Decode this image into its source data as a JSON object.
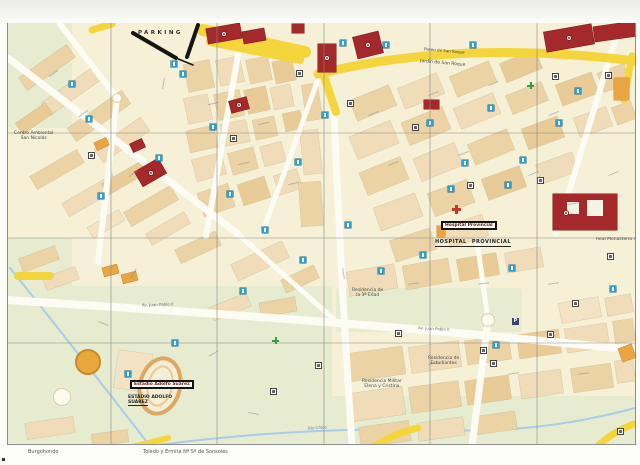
{
  "page": {
    "captions": {
      "left": "Burgohondo",
      "center": "Toledo y Ermita Nª Sª de Sonsoles"
    }
  },
  "map": {
    "labels": {
      "parking": "PARKING",
      "paseo_san_roque": "Paseo de San Roque",
      "jardin_san_roque": "Jardín de San Roque",
      "hospital_box": "Hospital Provincial",
      "hospital_caps": "HOSPITAL  PROVINCIAL",
      "estadio_box": "Estadio Adolfo Suárez",
      "estadio_caps_1": "ESTADIO ADOLFO",
      "estadio_caps_2": "SUÁREZ",
      "monasterio": "Real Monasterio de S...",
      "centro_ambiental_1": "Centro Ambiental",
      "centro_ambiental_2": "San Nicolás",
      "residencia_estudiantes_1": "Residencia de",
      "residencia_estudiantes_2": "Estudiantes",
      "residencia_militar_1": "Residencia Militar",
      "residencia_militar_2": "Elena y Cristina",
      "residencia_3edad_1": "Residencia de",
      "residencia_3edad_2": "la 3ª Edad",
      "rio_chico": "Río Chico",
      "av_juan_pablo": "Av. Juan Pablo II"
    },
    "colors": {
      "background": "#f5f0d6",
      "block": "#ecd3a6",
      "building_red": "#a5282a",
      "building_orange": "#e9a544",
      "road_main": "#f5d53c",
      "park": "#e7ecd0",
      "water": "#a9cde9",
      "icon_blue": "#2ba0d6",
      "wall_black": "#151515",
      "pharmacy_green": "#2f9e44",
      "hospital_red": "#c0392b"
    },
    "parks": [
      [
        0,
        0,
        64,
        105
      ],
      [
        0,
        215,
        64,
        110
      ],
      [
        0,
        263,
        324,
        158
      ],
      [
        322,
        373,
        305,
        48
      ],
      [
        328,
        265,
        186,
        44
      ],
      [
        52,
        337,
        120,
        86
      ]
    ],
    "river": [
      "M2,245 Q52,307 142,423",
      "M142,423 Q292,403 432,407",
      "M432,407 Q532,411 627,385"
    ],
    "roads_white": [
      [
        "M0,35 L230,211",
        7
      ],
      [
        "M109,75 L90,239",
        6
      ],
      [
        "M52,1 L109,75",
        6
      ],
      [
        "M0,277 C142,287 312,295 627,327",
        8
      ],
      [
        "M232,21 L198,213",
        6
      ],
      [
        "M326,89 Q332,237 344,423",
        7
      ],
      [
        "M480,297 L464,423",
        7
      ],
      [
        "M480,297 L469,217",
        5
      ],
      [
        "M612,1 L548,211",
        6
      ],
      [
        "M312,51 L254,211",
        5
      ],
      [
        "M230,211 L330,300",
        5
      ]
    ],
    "roads_yellow": [
      [
        "M310,51 Q450,16 627,38",
        9
      ],
      [
        "M314,47 L328,89",
        8
      ],
      [
        "M195,7 L297,29",
        12
      ],
      [
        "M202,19 L292,37",
        8
      ],
      [
        "M366,423 Q390,409 410,405",
        7
      ],
      [
        "M590,423 Q604,409 626,401",
        7
      ],
      [
        "M120,425 L160,415",
        6
      ],
      [
        "M624,33 L616,77",
        7
      ],
      [
        "M84,7 L104,1",
        7
      ],
      [
        "M10,253 L42,253",
        8
      ]
    ],
    "walls": [
      [
        "M125,10 L168,35",
        4
      ],
      [
        "M190,2 L179,34",
        4
      ],
      [
        "M168,35 L185,42",
        1.5
      ]
    ],
    "grid_x": [
      103,
      209,
      316,
      422,
      529
    ],
    "grid_y": [
      110,
      215,
      320
    ],
    "blocks": [
      [
        10,
        37,
        58,
        15,
        -35,
        0
      ],
      [
        32,
        61,
        62,
        15,
        -35,
        1
      ],
      [
        58,
        85,
        66,
        16,
        -35,
        0
      ],
      [
        8,
        89,
        36,
        13,
        -35,
        2
      ],
      [
        86,
        109,
        56,
        16,
        -35,
        1
      ],
      [
        22,
        139,
        54,
        15,
        -30,
        0
      ],
      [
        54,
        165,
        58,
        15,
        -30,
        1
      ],
      [
        94,
        149,
        44,
        13,
        -30,
        2
      ],
      [
        116,
        175,
        54,
        16,
        -30,
        0
      ],
      [
        138,
        199,
        44,
        13,
        -30,
        1
      ],
      [
        80,
        195,
        36,
        12,
        -30,
        3
      ],
      [
        178,
        39,
        26,
        28,
        -12,
        0
      ],
      [
        210,
        35,
        24,
        26,
        -12,
        1
      ],
      [
        240,
        35,
        22,
        24,
        -12,
        0
      ],
      [
        266,
        37,
        20,
        22,
        -12,
        2
      ],
      [
        178,
        73,
        24,
        26,
        -12,
        1
      ],
      [
        208,
        69,
        26,
        26,
        -12,
        0
      ],
      [
        238,
        65,
        22,
        24,
        -12,
        2
      ],
      [
        264,
        63,
        20,
        22,
        -12,
        1
      ],
      [
        180,
        105,
        28,
        22,
        -12,
        0
      ],
      [
        214,
        99,
        26,
        22,
        -12,
        1
      ],
      [
        246,
        95,
        22,
        20,
        -12,
        0
      ],
      [
        276,
        89,
        18,
        18,
        -12,
        2
      ],
      [
        186,
        133,
        30,
        22,
        -15,
        1
      ],
      [
        222,
        127,
        26,
        22,
        -15,
        0
      ],
      [
        254,
        121,
        22,
        20,
        -15,
        1
      ],
      [
        192,
        165,
        32,
        24,
        -18,
        0
      ],
      [
        232,
        157,
        28,
        22,
        -18,
        2
      ],
      [
        268,
        149,
        24,
        20,
        -18,
        1
      ],
      [
        296,
        61,
        16,
        36,
        -8,
        0
      ],
      [
        294,
        107,
        18,
        44,
        -6,
        1
      ],
      [
        292,
        159,
        22,
        44,
        -4,
        0
      ],
      [
        344,
        69,
        42,
        22,
        -22,
        0
      ],
      [
        392,
        57,
        42,
        22,
        -22,
        1
      ],
      [
        444,
        45,
        42,
        22,
        -22,
        0
      ],
      [
        494,
        33,
        38,
        20,
        -22,
        2
      ],
      [
        344,
        105,
        44,
        24,
        -22,
        1
      ],
      [
        396,
        91,
        44,
        24,
        -22,
        0
      ],
      [
        448,
        77,
        42,
        22,
        -22,
        1
      ],
      [
        500,
        65,
        38,
        20,
        -22,
        0
      ],
      [
        550,
        55,
        38,
        22,
        -20,
        2
      ],
      [
        592,
        45,
        28,
        20,
        -20,
        0
      ],
      [
        354,
        141,
        44,
        24,
        -22,
        0
      ],
      [
        408,
        127,
        44,
        24,
        -22,
        1
      ],
      [
        462,
        113,
        42,
        22,
        -22,
        0
      ],
      [
        516,
        99,
        38,
        22,
        -20,
        2
      ],
      [
        568,
        89,
        34,
        20,
        -20,
        1
      ],
      [
        606,
        81,
        20,
        18,
        -20,
        0
      ],
      [
        368,
        177,
        44,
        24,
        -20,
        1
      ],
      [
        422,
        163,
        42,
        24,
        -20,
        0
      ],
      [
        476,
        149,
        40,
        22,
        -20,
        2
      ],
      [
        530,
        135,
        38,
        20,
        -20,
        1
      ],
      [
        384,
        211,
        42,
        22,
        -18,
        0
      ],
      [
        438,
        197,
        40,
        22,
        -18,
        1
      ],
      [
        340,
        245,
        48,
        24,
        -10,
        1
      ],
      [
        396,
        239,
        46,
        24,
        -10,
        0
      ],
      [
        450,
        233,
        40,
        22,
        -10,
        2
      ],
      [
        498,
        227,
        36,
        20,
        -10,
        1
      ],
      [
        338,
        327,
        58,
        28,
        -8,
        0
      ],
      [
        402,
        321,
        50,
        26,
        -8,
        1
      ],
      [
        458,
        315,
        44,
        24,
        -8,
        0
      ],
      [
        510,
        309,
        42,
        24,
        -8,
        2
      ],
      [
        558,
        303,
        42,
        24,
        -8,
        1
      ],
      [
        606,
        297,
        20,
        22,
        -8,
        0
      ],
      [
        342,
        367,
        54,
        28,
        -8,
        1
      ],
      [
        402,
        361,
        50,
        26,
        -8,
        0
      ],
      [
        458,
        355,
        44,
        24,
        -8,
        2
      ],
      [
        512,
        349,
        42,
        24,
        -8,
        1
      ],
      [
        564,
        343,
        40,
        24,
        -8,
        0
      ],
      [
        608,
        337,
        18,
        22,
        -8,
        1
      ],
      [
        352,
        401,
        50,
        20,
        -8,
        0
      ],
      [
        410,
        397,
        46,
        18,
        -8,
        1
      ],
      [
        466,
        391,
        42,
        18,
        -8,
        0
      ],
      [
        552,
        277,
        40,
        20,
        -10,
        3
      ],
      [
        598,
        273,
        26,
        18,
        -10,
        1
      ],
      [
        12,
        229,
        38,
        14,
        -20,
        0
      ],
      [
        36,
        249,
        34,
        13,
        -20,
        1
      ],
      [
        168,
        217,
        44,
        15,
        -25,
        0
      ],
      [
        224,
        229,
        56,
        18,
        -25,
        1
      ],
      [
        274,
        249,
        36,
        14,
        -25,
        0
      ],
      [
        108,
        329,
        34,
        38,
        8,
        3
      ],
      [
        18,
        397,
        48,
        16,
        -8,
        1
      ],
      [
        84,
        409,
        36,
        12,
        -8,
        0
      ],
      [
        202,
        277,
        40,
        14,
        -22,
        1
      ],
      [
        252,
        277,
        36,
        14,
        -10,
        0
      ]
    ],
    "orange_buildings": [
      [
        87,
        117,
        13,
        8,
        -25
      ],
      [
        95,
        243,
        15,
        9,
        -15
      ],
      [
        114,
        250,
        15,
        9,
        -15
      ],
      [
        606,
        55,
        15,
        22,
        0
      ],
      [
        612,
        323,
        14,
        14,
        -20
      ],
      [
        444,
        199,
        10,
        7,
        0
      ],
      [
        429,
        203,
        8,
        11,
        0
      ]
    ],
    "red_buildings": [
      [
        199,
        3,
        34,
        15,
        -10,
        1
      ],
      [
        235,
        7,
        22,
        12,
        -10,
        0
      ],
      [
        284,
        1,
        12,
        9,
        0,
        0
      ],
      [
        310,
        21,
        18,
        28,
        0,
        1
      ],
      [
        347,
        11,
        26,
        22,
        -14,
        1
      ],
      [
        416,
        77,
        15,
        9,
        0,
        0
      ],
      [
        537,
        5,
        48,
        20,
        -10,
        1
      ],
      [
        586,
        1,
        42,
        15,
        -8,
        0
      ],
      [
        222,
        76,
        18,
        12,
        -15,
        1
      ],
      [
        123,
        118,
        13,
        9,
        -25,
        0
      ],
      [
        129,
        141,
        27,
        17,
        -30,
        1
      ]
    ],
    "monasterio": {
      "x": 545,
      "y": 171,
      "w": 64,
      "h": 36,
      "courtyards": [
        [
          14,
          8,
          12,
          12
        ],
        [
          34,
          6,
          16,
          16
        ]
      ],
      "marker": [
        10,
        16
      ]
    },
    "roundabouts": [
      [
        109,
        75,
        5
      ],
      [
        480,
        297,
        7
      ],
      [
        54,
        374,
        9
      ]
    ],
    "plaza_toros": [
      80,
      339,
      13
    ],
    "green_cross": [
      [
        264,
        314
      ],
      [
        519,
        59
      ]
    ],
    "red_cross": [
      [
        444,
        182
      ]
    ],
    "navy_p": [
      [
        504,
        295
      ]
    ],
    "icons_blue": [
      [
        61,
        58
      ],
      [
        78,
        93
      ],
      [
        90,
        170
      ],
      [
        163,
        38
      ],
      [
        172,
        48
      ],
      [
        148,
        132
      ],
      [
        202,
        101
      ],
      [
        219,
        168
      ],
      [
        254,
        204
      ],
      [
        287,
        136
      ],
      [
        314,
        89
      ],
      [
        332,
        17
      ],
      [
        375,
        19
      ],
      [
        462,
        19
      ],
      [
        419,
        97
      ],
      [
        480,
        82
      ],
      [
        512,
        134
      ],
      [
        497,
        159
      ],
      [
        567,
        65
      ],
      [
        501,
        242
      ],
      [
        485,
        319
      ],
      [
        412,
        229
      ],
      [
        337,
        199
      ],
      [
        292,
        234
      ],
      [
        232,
        265
      ],
      [
        117,
        348
      ],
      [
        164,
        317
      ],
      [
        440,
        163
      ],
      [
        548,
        97
      ],
      [
        602,
        263
      ],
      [
        454,
        137
      ],
      [
        370,
        245
      ]
    ],
    "icons_white": [
      [
        288,
        47
      ],
      [
        222,
        112
      ],
      [
        339,
        77
      ],
      [
        404,
        101
      ],
      [
        544,
        50
      ],
      [
        597,
        49
      ],
      [
        529,
        154
      ],
      [
        459,
        159
      ],
      [
        599,
        230
      ],
      [
        472,
        324
      ],
      [
        482,
        337
      ],
      [
        539,
        308
      ],
      [
        564,
        277
      ],
      [
        387,
        307
      ],
      [
        262,
        365
      ],
      [
        307,
        339
      ],
      [
        609,
        405
      ],
      [
        80,
        129
      ]
    ],
    "street_marks": [
      [
        40,
        50,
        -35
      ],
      [
        70,
        90,
        -35
      ],
      [
        120,
        150,
        -35
      ],
      [
        150,
        60,
        -80
      ],
      [
        200,
        80,
        -12
      ],
      [
        250,
        100,
        -12
      ],
      [
        230,
        140,
        -12
      ],
      [
        280,
        160,
        -12
      ],
      [
        360,
        90,
        -22
      ],
      [
        420,
        70,
        -22
      ],
      [
        480,
        60,
        -22
      ],
      [
        540,
        90,
        -22
      ],
      [
        380,
        140,
        -22
      ],
      [
        450,
        130,
        -22
      ],
      [
        520,
        150,
        -22
      ],
      [
        560,
        180,
        -10
      ],
      [
        400,
        260,
        -8
      ],
      [
        470,
        260,
        -8
      ],
      [
        540,
        260,
        -8
      ],
      [
        420,
        340,
        -8
      ],
      [
        500,
        350,
        -8
      ],
      [
        570,
        350,
        -8
      ],
      [
        120,
        250,
        -60
      ],
      [
        90,
        300,
        20
      ],
      [
        200,
        330,
        -30
      ],
      [
        240,
        390,
        10
      ],
      [
        330,
        250,
        80
      ],
      [
        600,
        150,
        -22
      ]
    ]
  }
}
